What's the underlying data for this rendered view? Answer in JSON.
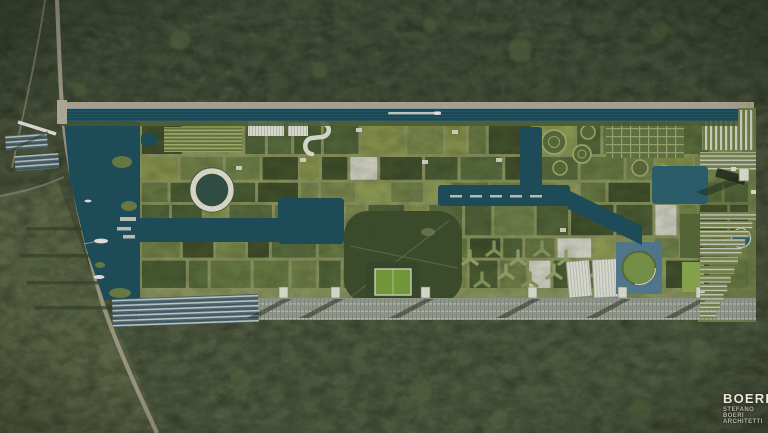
{
  "logo": {
    "brand": "BOERI",
    "studio_lines": [
      "STEFANO",
      "BOERI",
      "ARCHITETTI"
    ]
  },
  "scene": {
    "palette": {
      "forest": "#4c573d",
      "forest_dark": "#46523a",
      "forest_low": "#525e42",
      "field": "#5f6a48",
      "water": "#20525f",
      "water_light": "#577f97",
      "road": "#a6a18c",
      "road_light": "#b3ad99",
      "white": "#e3e5d8",
      "shadow": "#242e1c",
      "city_base": "#8f9a62",
      "block_white": "#d7d9c9",
      "block_dark": "#45542f",
      "block_colors": [
        "#7e8c4f",
        "#6b7d45",
        "#5d7040",
        "#8a964f",
        "#55683c",
        "#74854b",
        "#93a058",
        "#4e6136"
      ]
    },
    "blocks": {
      "seed": 123457,
      "x0": 142,
      "x1": 748,
      "y0": 126,
      "y1": 294,
      "min_w": 16,
      "max_w": 44,
      "min_h": 14,
      "max_h": 32,
      "gap": 3,
      "white_p": 0.05,
      "dark_p": 0.14
    }
  }
}
